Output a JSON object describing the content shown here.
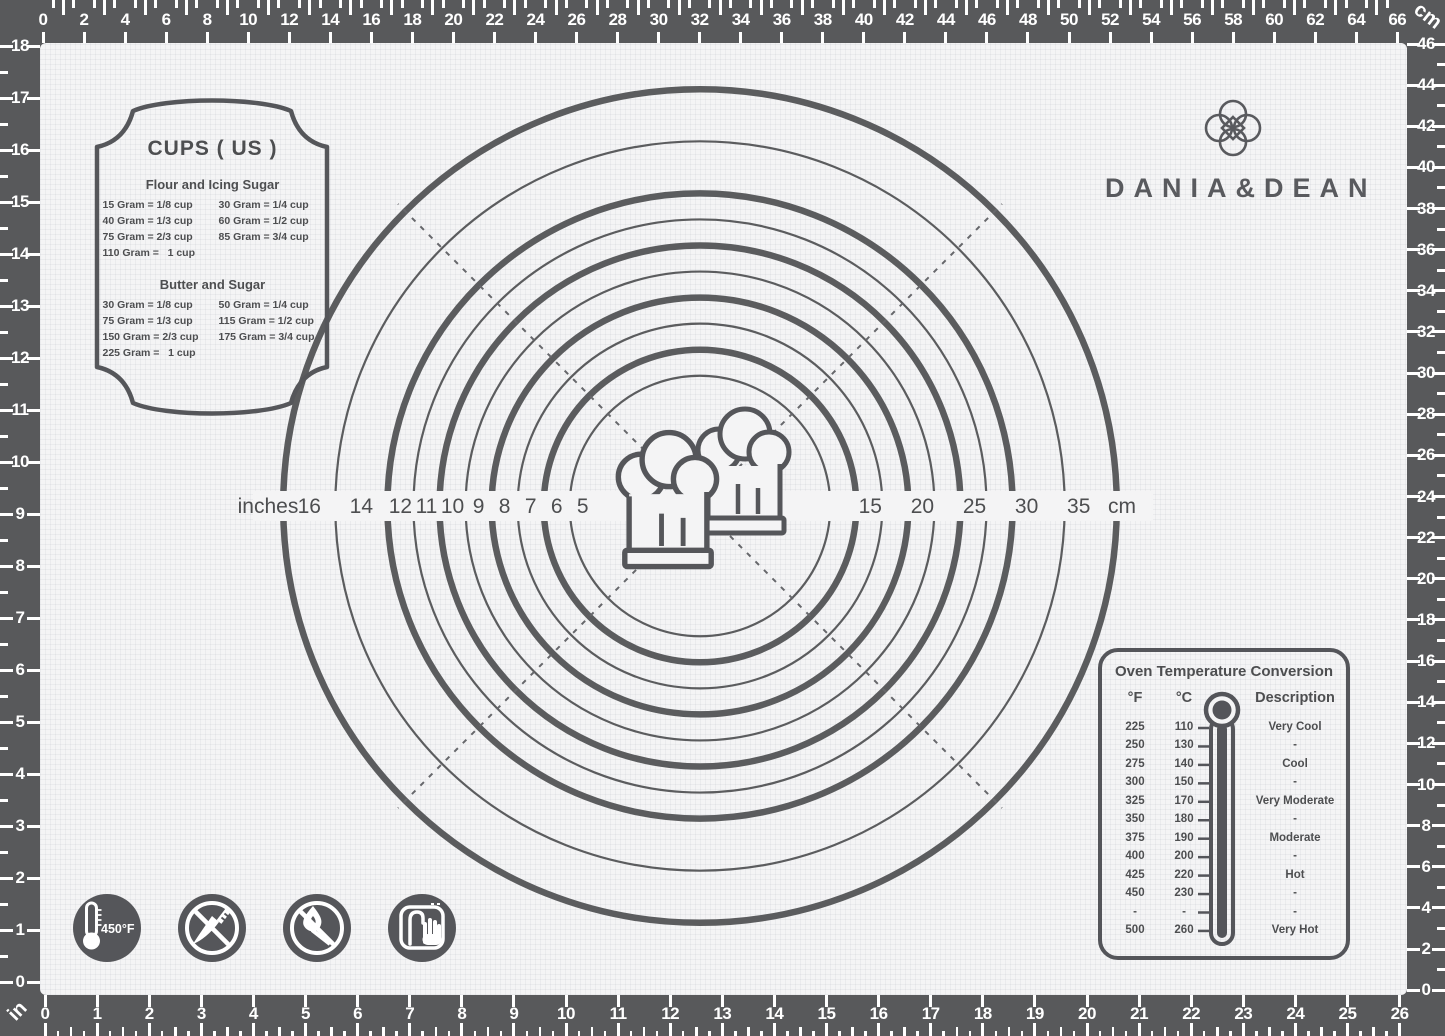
{
  "brand": {
    "name": "DANIA&DEAN",
    "logo_icon": "clover-knot-icon"
  },
  "rulers": {
    "top": {
      "unit": "cm",
      "labels": [
        0,
        2,
        4,
        6,
        8,
        10,
        12,
        14,
        16,
        18,
        20,
        22,
        24,
        26,
        28,
        30,
        32,
        34,
        36,
        38,
        40,
        42,
        44,
        46,
        48,
        50,
        52,
        54,
        56,
        58,
        60,
        62,
        64,
        66
      ]
    },
    "right": {
      "unit": "cm",
      "labels": [
        46,
        44,
        42,
        40,
        38,
        36,
        34,
        32,
        30,
        28,
        26,
        24,
        22,
        20,
        18,
        16,
        14,
        12,
        10,
        8,
        6,
        4,
        2,
        0
      ]
    },
    "left": {
      "unit": "in",
      "labels": [
        18,
        17,
        16,
        15,
        14,
        13,
        12,
        11,
        10,
        9,
        8,
        7,
        6,
        5,
        4,
        3,
        2,
        1,
        0
      ]
    },
    "bottom": {
      "unit": "in",
      "labels": [
        0,
        1,
        2,
        3,
        4,
        5,
        6,
        7,
        8,
        9,
        10,
        11,
        12,
        13,
        14,
        15,
        16,
        17,
        18,
        19,
        20,
        21,
        22,
        23,
        24,
        25,
        26
      ]
    },
    "top_unit_label": "cm",
    "bottom_unit_label": "in"
  },
  "circles": {
    "left_axis_label": "inches",
    "right_axis_label": "cm",
    "inch_ring_diameters": [
      16,
      14,
      12,
      11,
      10,
      9,
      8,
      7,
      6,
      5
    ],
    "cm_labels": [
      {
        "cm": 15,
        "inch_ring": 6
      },
      {
        "cm": 20,
        "inch_ring": 8
      },
      {
        "cm": 25,
        "inch_ring": 10
      },
      {
        "cm": 30,
        "inch_ring": 12
      },
      {
        "cm": 35,
        "inch_ring": 14
      }
    ],
    "center_icon": "chef-hats-icon"
  },
  "cups_panel": {
    "title": "CUPS ( US )",
    "sections": [
      {
        "heading": "Flour and Icing Sugar",
        "rows": [
          [
            "15 Gram = 1/8 cup",
            "30 Gram = 1/4 cup"
          ],
          [
            "40 Gram = 1/3 cup",
            "60 Gram = 1/2 cup"
          ],
          [
            "75 Gram = 2/3 cup",
            "85 Gram = 3/4 cup"
          ],
          [
            "110 Gram =   1 cup",
            ""
          ]
        ]
      },
      {
        "heading": "Butter and Sugar",
        "rows": [
          [
            "30 Gram = 1/8 cup",
            "50 Gram = 1/4 cup"
          ],
          [
            "75 Gram = 1/3 cup",
            "115 Gram = 1/2 cup"
          ],
          [
            "150 Gram = 2/3 cup",
            "175 Gram = 3/4 cup"
          ],
          [
            "225 Gram =   1 cup",
            ""
          ]
        ]
      }
    ]
  },
  "oven_panel": {
    "title": "Oven Temperature Conversion",
    "headers": [
      "°F",
      "°C",
      "Description"
    ],
    "rows": [
      [
        "225",
        "110",
        "Very Cool"
      ],
      [
        "250",
        "130",
        "-"
      ],
      [
        "275",
        "140",
        "Cool"
      ],
      [
        "300",
        "150",
        "-"
      ],
      [
        "325",
        "170",
        "Very Moderate"
      ],
      [
        "350",
        "180",
        "-"
      ],
      [
        "375",
        "190",
        "Moderate"
      ],
      [
        "400",
        "200",
        "-"
      ],
      [
        "425",
        "220",
        "Hot"
      ],
      [
        "450",
        "230",
        "-"
      ],
      [
        "-",
        "-",
        "-"
      ],
      [
        "500",
        "260",
        "Very Hot"
      ]
    ]
  },
  "safety_icons": [
    {
      "name": "max-temperature-icon",
      "label": "450°F"
    },
    {
      "name": "no-knives-icon",
      "label": ""
    },
    {
      "name": "no-open-flame-icon",
      "label": ""
    },
    {
      "name": "hand-wash-only-icon",
      "label": ""
    }
  ],
  "colors": {
    "frame": "#58595b",
    "mat": "#f4f4f5",
    "ink": "#4d4e50",
    "ring": "#5b5c5e",
    "tick": "#ffffff"
  }
}
